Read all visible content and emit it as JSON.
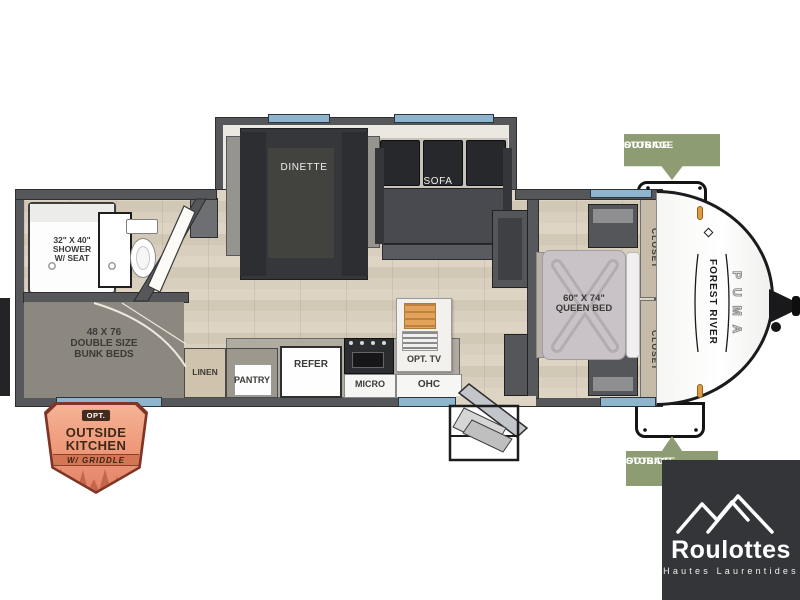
{
  "floorplan": {
    "slide": {
      "dinette": "DINETTE",
      "sofa": "SOFA"
    },
    "bathroom": {
      "shower": [
        "32\" X 40\"",
        "SHOWER",
        "W/ SEAT"
      ]
    },
    "bunk_room": {
      "label": [
        "48 X 76",
        "DOUBLE SIZE",
        "BUNK BEDS"
      ]
    },
    "kitchen": {
      "linen": "LINEN",
      "pantry": "PANTRY",
      "refer": "REFER",
      "micro": "MICRO",
      "opt_tv": "OPT. TV",
      "ohc": "OHC"
    },
    "bedroom": {
      "bed": [
        "60\" X 74\"",
        "QUEEN BED"
      ],
      "closet_top": "CLOSET",
      "closet_bottom": "CLOSET"
    },
    "exterior": {
      "brand": "FOREST RIVER",
      "model": "PUMA",
      "storage_top": [
        "OUTSIDE",
        "STORAGE"
      ],
      "storage_bottom": [
        "OUTSIDE",
        "STORAGE"
      ]
    }
  },
  "badge": {
    "opt": "OPT.",
    "line1": "OUTSIDE",
    "line2": "KITCHEN",
    "line3": "W/ GRIDDLE"
  },
  "dealer": {
    "name": "Roulottes",
    "subtitle": "Hautes Laurentides"
  },
  "colors": {
    "window_blue": "#8fb4cd",
    "wall_gray": "#56575a",
    "storage_green": "#8d9c73",
    "badge_salmon": "#ef9c7c",
    "logo_bg": "#333538"
  }
}
